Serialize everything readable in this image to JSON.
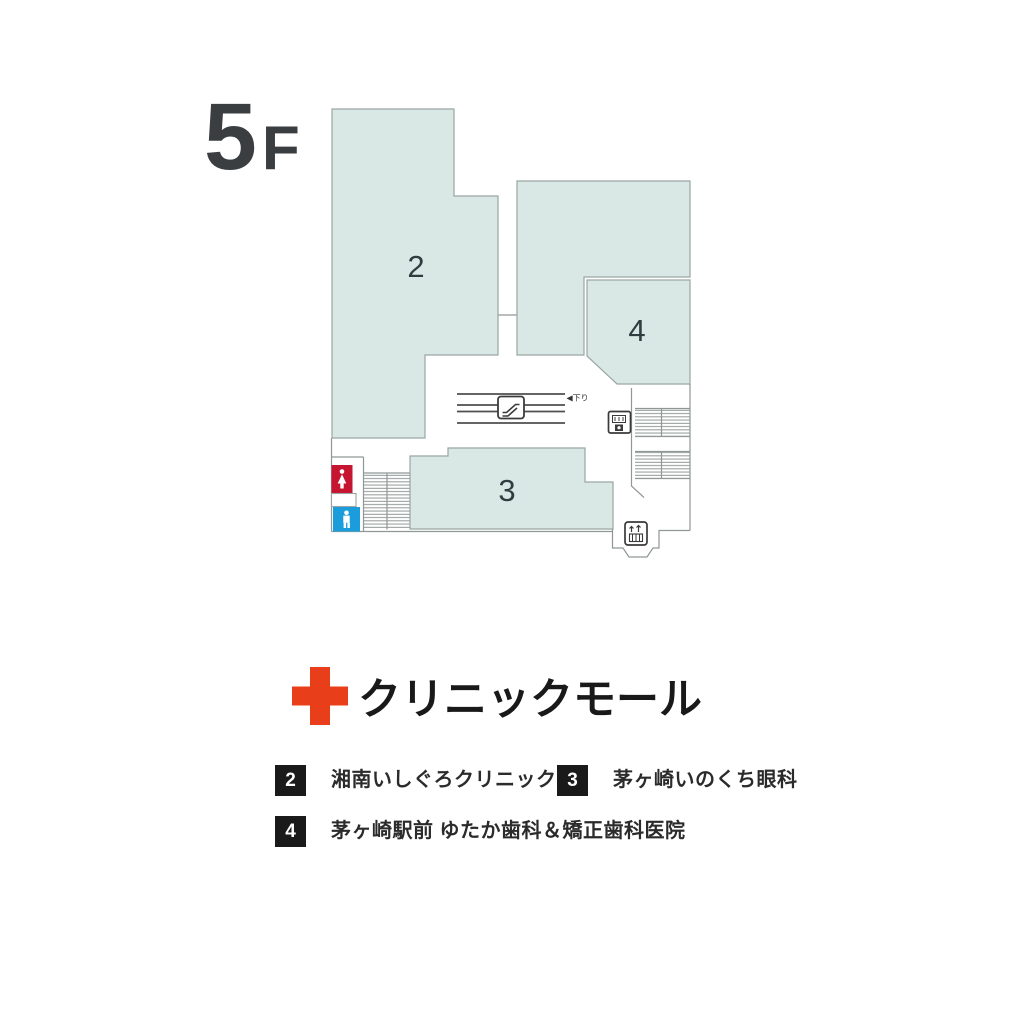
{
  "floor_label": {
    "number": "5",
    "suffix": "F"
  },
  "map": {
    "room_labels": {
      "room2": "2",
      "room3": "3",
      "room4": "4"
    },
    "escalator_direction": "◀下り"
  },
  "title": {
    "name": "クリニックモール"
  },
  "legend": {
    "items": [
      {
        "num": "2",
        "name": "湘南いしぐろクリニック"
      },
      {
        "num": "3",
        "name": "茅ヶ崎いのくち眼科"
      },
      {
        "num": "4",
        "name": "茅ヶ崎駅前 ゆたか歯科＆矯正歯科医院"
      }
    ]
  },
  "icons": [
    "red-cross-icon",
    "escalator-icon",
    "elevator-icon",
    "exit-elevator-icon",
    "female-toilet-icon",
    "male-toilet-icon",
    "stairs-hatching"
  ],
  "colors": {
    "room_fill": "#d9e8e4",
    "room_border": "#9aa6a3",
    "wall_line": "#8f9896",
    "escalator_rail": "#4f4f4f",
    "room_number": "#2e3e40",
    "floor_label": "#3a3e41",
    "cross_red": "#e83e1a",
    "title_text": "#191919",
    "legend_chip_bg": "#1a1a1a",
    "toilet_female_red": "#c61531",
    "toilet_male_blue": "#1b9ddc"
  }
}
